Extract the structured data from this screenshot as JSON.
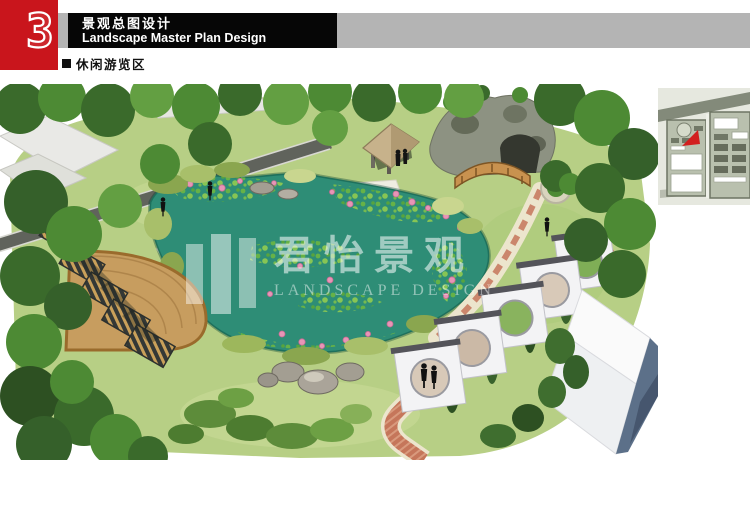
{
  "page": {
    "background": "#ffffff"
  },
  "header": {
    "chapter_number": "3",
    "title_zh": "景观总图设计",
    "title_en": "Landscape Master Plan Design",
    "colors": {
      "accent_red": "#c9151c",
      "bar_black": "#060606",
      "bar_gray": "#b4b4b4"
    }
  },
  "section": {
    "bullet": "■",
    "label": "休闲游览区"
  },
  "watermark": {
    "name_zh": "君怡景观",
    "name_en": "LANDSCAPE DESIGN"
  },
  "rendering": {
    "alt": "aerial perspective rendering of the leisure touring area: lotus pond with pavilion, stone grotto, arch bridge, fan-shaped wood deck with pergolas, moon-gate walls and brick paths",
    "palette": {
      "pond": "#2e8d76",
      "lilypad": "#7cc24a",
      "lotus_pink": "#e795b6",
      "lawn": "#b7cf85",
      "tree_dark": "#3a6a2b",
      "tree_mid": "#4d8a34",
      "deck_wood": "#c79d5f",
      "brick_path": "#c5765a",
      "gate_wall": "#f3f3f5",
      "building_side": "#5c7089",
      "rock": "#a39e92",
      "road": "#60635c"
    }
  },
  "site_plan_thumbnail": {
    "marker_color": "#d21f1f",
    "background": "#e6e8df",
    "road": "#838a7a"
  }
}
